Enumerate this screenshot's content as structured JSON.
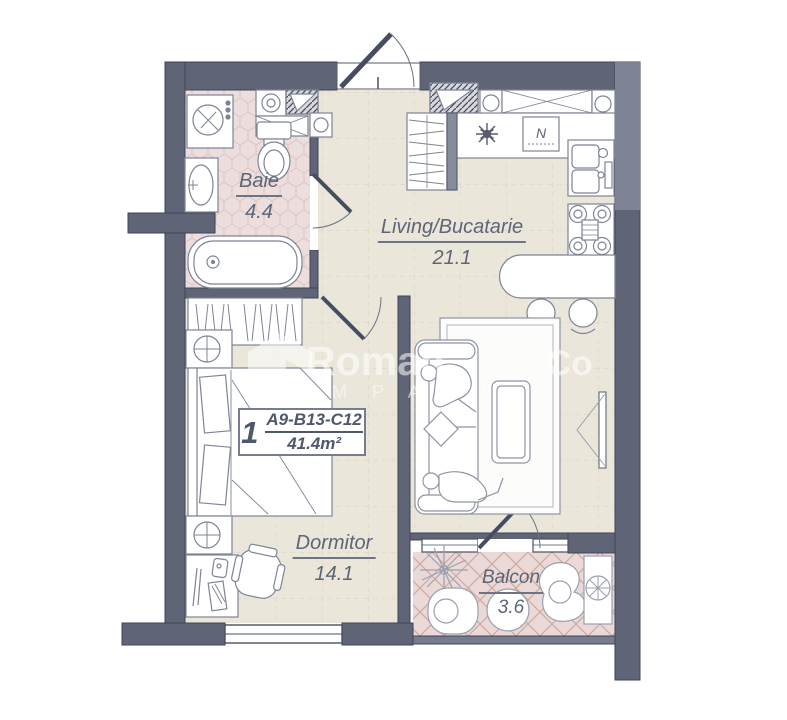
{
  "rooms": [
    {
      "name": "Baie",
      "area": "4.4"
    },
    {
      "name": "Living/Bucatarie",
      "area": "21.1"
    },
    {
      "name": "Dormitor",
      "area": "14.1"
    },
    {
      "name": "Balcon",
      "area": "3.6"
    }
  ],
  "unit": {
    "number": "1",
    "code": "A9-B13-C12",
    "area": "41.4m²"
  },
  "kitchen": {
    "boiler_label": "N"
  },
  "watermark": {
    "main": "Roman",
    "main2": "Co",
    "sub": "M P A N I"
  },
  "colors": {
    "wall": "#5f6577",
    "wall_light": "#7e8395",
    "floor_beige": "#eae6da",
    "floor_pink": "#ecdedd",
    "balcony_pink": "#ead9d6",
    "text": "#5e6577"
  }
}
